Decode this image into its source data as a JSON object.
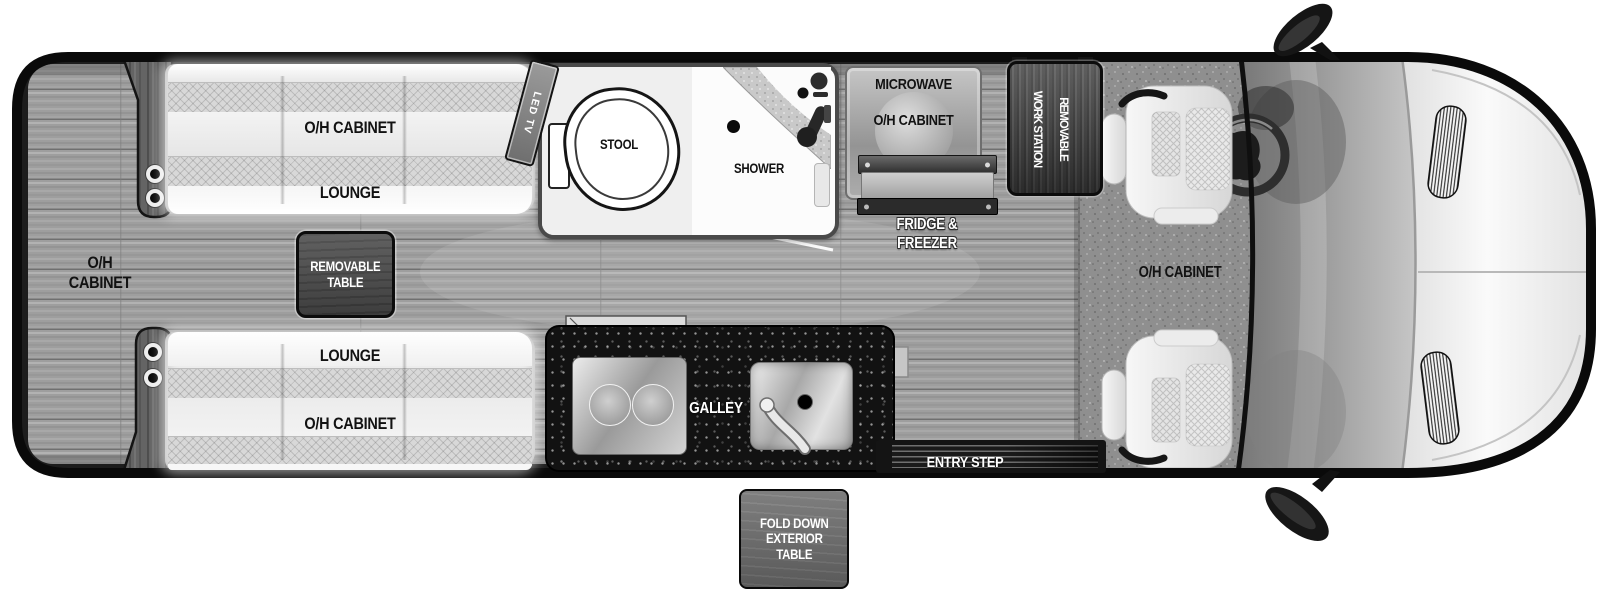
{
  "floorplan": {
    "rear_cabinet": {
      "line1": "O/H",
      "line2": "CABINET"
    },
    "lounge_top": {
      "cabinet": "O/H CABINET",
      "lounge": "LOUNGE"
    },
    "lounge_bottom": {
      "lounge": "LOUNGE",
      "cabinet": "O/H CABINET"
    },
    "removable_table": {
      "line1": "REMOVABLE",
      "line2": "TABLE"
    },
    "led_tv": "LED TV",
    "bathroom": {
      "stool": "STOOL",
      "shower": "SHOWER"
    },
    "kitchen": {
      "microwave": "MICROWAVE",
      "cabinet": "O/H CABINET",
      "fridge_line1": "FRIDGE &",
      "fridge_line2": "FREEZER",
      "galley": "GALLEY"
    },
    "work_station": {
      "line1": "REMOVABLE",
      "line2": "WORK STATION"
    },
    "entry_step": "ENTRY STEP",
    "fold_down_table": {
      "line1": "FOLD DOWN",
      "line2": "EXTERIOR",
      "line3": "TABLE"
    },
    "cab": {
      "cabinet": "O/H CABINET"
    }
  },
  "colors": {
    "body_outline": "#0a0a0a",
    "wall_band": "#1c1c1c",
    "floor_wood": "#9e9e9e",
    "galley_counter": "#121212",
    "dark_box": "#4b4b4b",
    "exterior_table_box": "#6d6d6d",
    "label_dark": "#121212",
    "label_light": "#ffffff"
  }
}
